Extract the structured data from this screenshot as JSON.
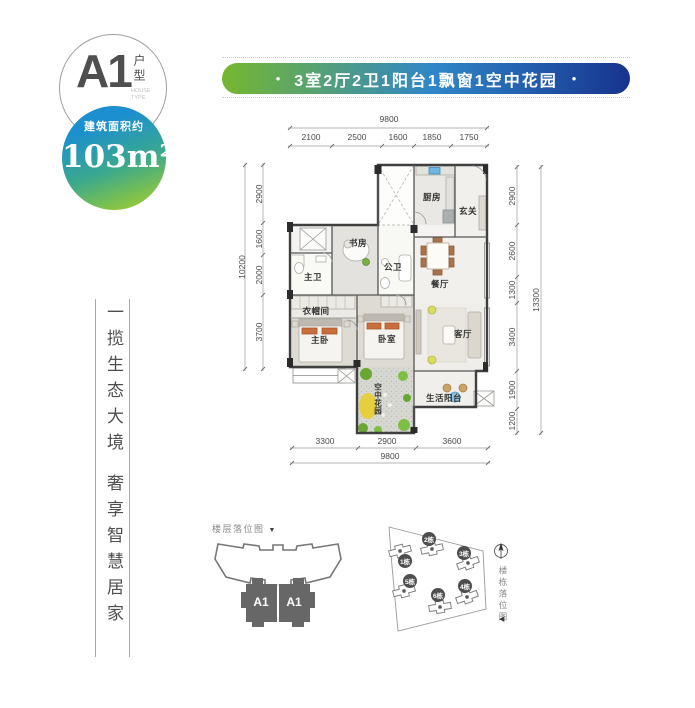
{
  "header": {
    "unit": {
      "code": "A1",
      "type_cn": "户型",
      "type_en_1": "HOUSE",
      "type_en_2": "TYPE"
    },
    "area": {
      "label": "建筑面积约",
      "value": "103m²"
    },
    "banner": {
      "dot": "•",
      "text": "3室2厅2卫1阳台1飘窗1空中花园"
    }
  },
  "tagline": {
    "line1": "一揽生态大境",
    "line2": "奢享智慧居家"
  },
  "floorplan": {
    "rooms": {
      "kitchen": "厨房",
      "entry": "玄关",
      "study": "书房",
      "guest_bath": "公卫",
      "master_bath": "主卫",
      "dining": "餐厅",
      "cloakroom": "衣帽间",
      "master_bedroom": "主卧",
      "bedroom": "卧室",
      "living": "客厅",
      "balcony": "生活阳台",
      "sky_garden": "空中花园"
    },
    "dims": {
      "top": {
        "total": "9800",
        "segments": [
          "2100",
          "2500",
          "1600",
          "1850",
          "1750"
        ]
      },
      "left": {
        "total": "10200",
        "segments": [
          "2900",
          "1600",
          "2000",
          "3700"
        ]
      },
      "right": {
        "total": "13300",
        "segments": [
          "2900",
          "2600",
          "1300",
          "3400",
          "1900",
          "1200"
        ]
      },
      "bottom": {
        "total": "9800",
        "segments": [
          "3300",
          "2900",
          "3600"
        ]
      }
    }
  },
  "floor_diagram": {
    "title": "楼层落位图",
    "arrow": "▼",
    "units": [
      "A1",
      "A1"
    ]
  },
  "site_diagram": {
    "title": "楼栋落位图",
    "arrow": "◀",
    "buildings": [
      "1栋",
      "2栋",
      "3栋",
      "4栋",
      "5栋",
      "6栋"
    ]
  },
  "colors": {
    "banner_green": "#76b72f",
    "banner_blue": "#16338e",
    "badge_blue": "#1b8fd0",
    "badge_green": "#8dc63f"
  }
}
